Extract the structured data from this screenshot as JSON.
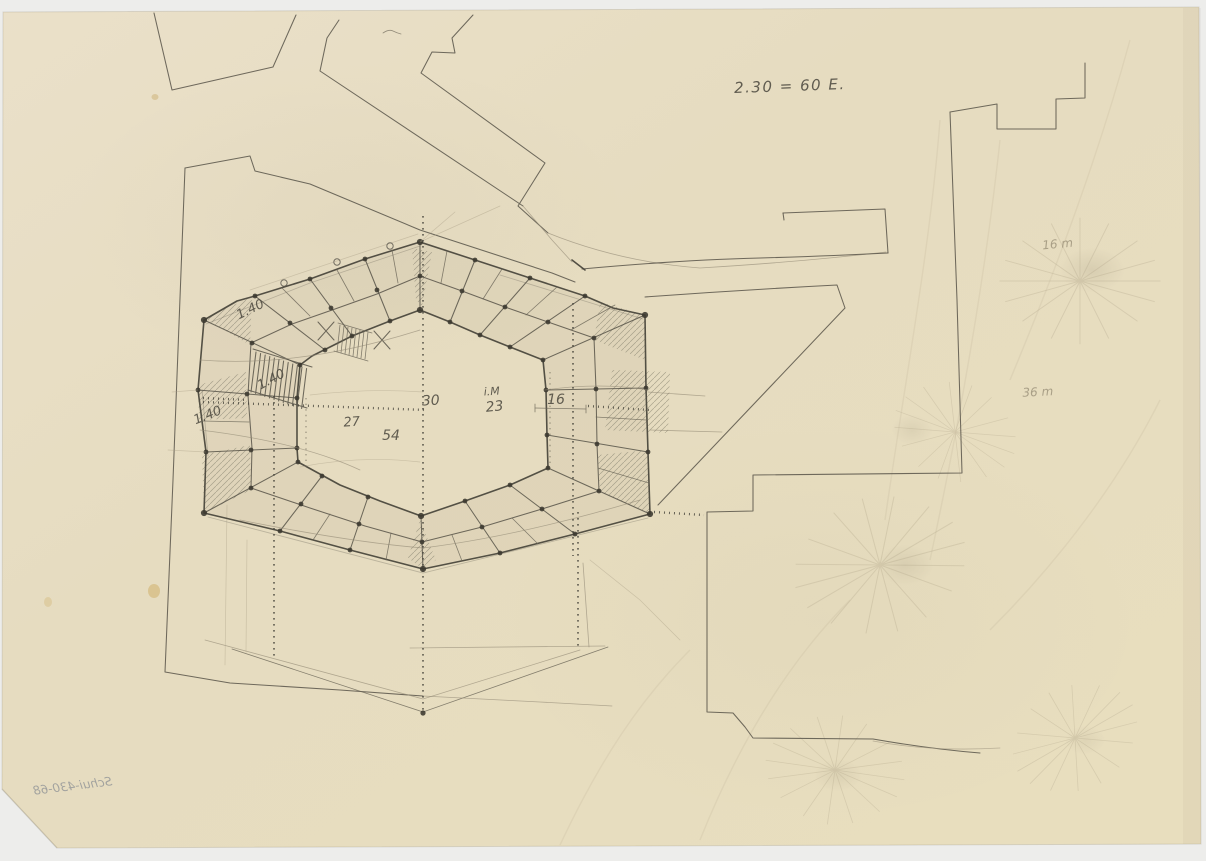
{
  "colors": {
    "paper": "#e7ddc2",
    "scan_bed": "#ededeb",
    "pencil_dark": "#46433a",
    "pencil_faint": "#938b76",
    "stain_yellow": "#c8a04a",
    "inscription_blue_gray": "#7e848e"
  },
  "annotations": {
    "scale_note": "2.30 = 60 E.",
    "dim_140_top": "1.40",
    "dim_140_mid": "1.40",
    "dim_140_left": "1.40",
    "dim_30": "30",
    "dim_im_label": "i.M",
    "dim_23": "23",
    "dim_16": "16",
    "dim_27": "27",
    "dim_54": "54",
    "note_16m": "16 m",
    "note_36m": "36 m",
    "inventory_mirrored": "Schui-430-68"
  }
}
